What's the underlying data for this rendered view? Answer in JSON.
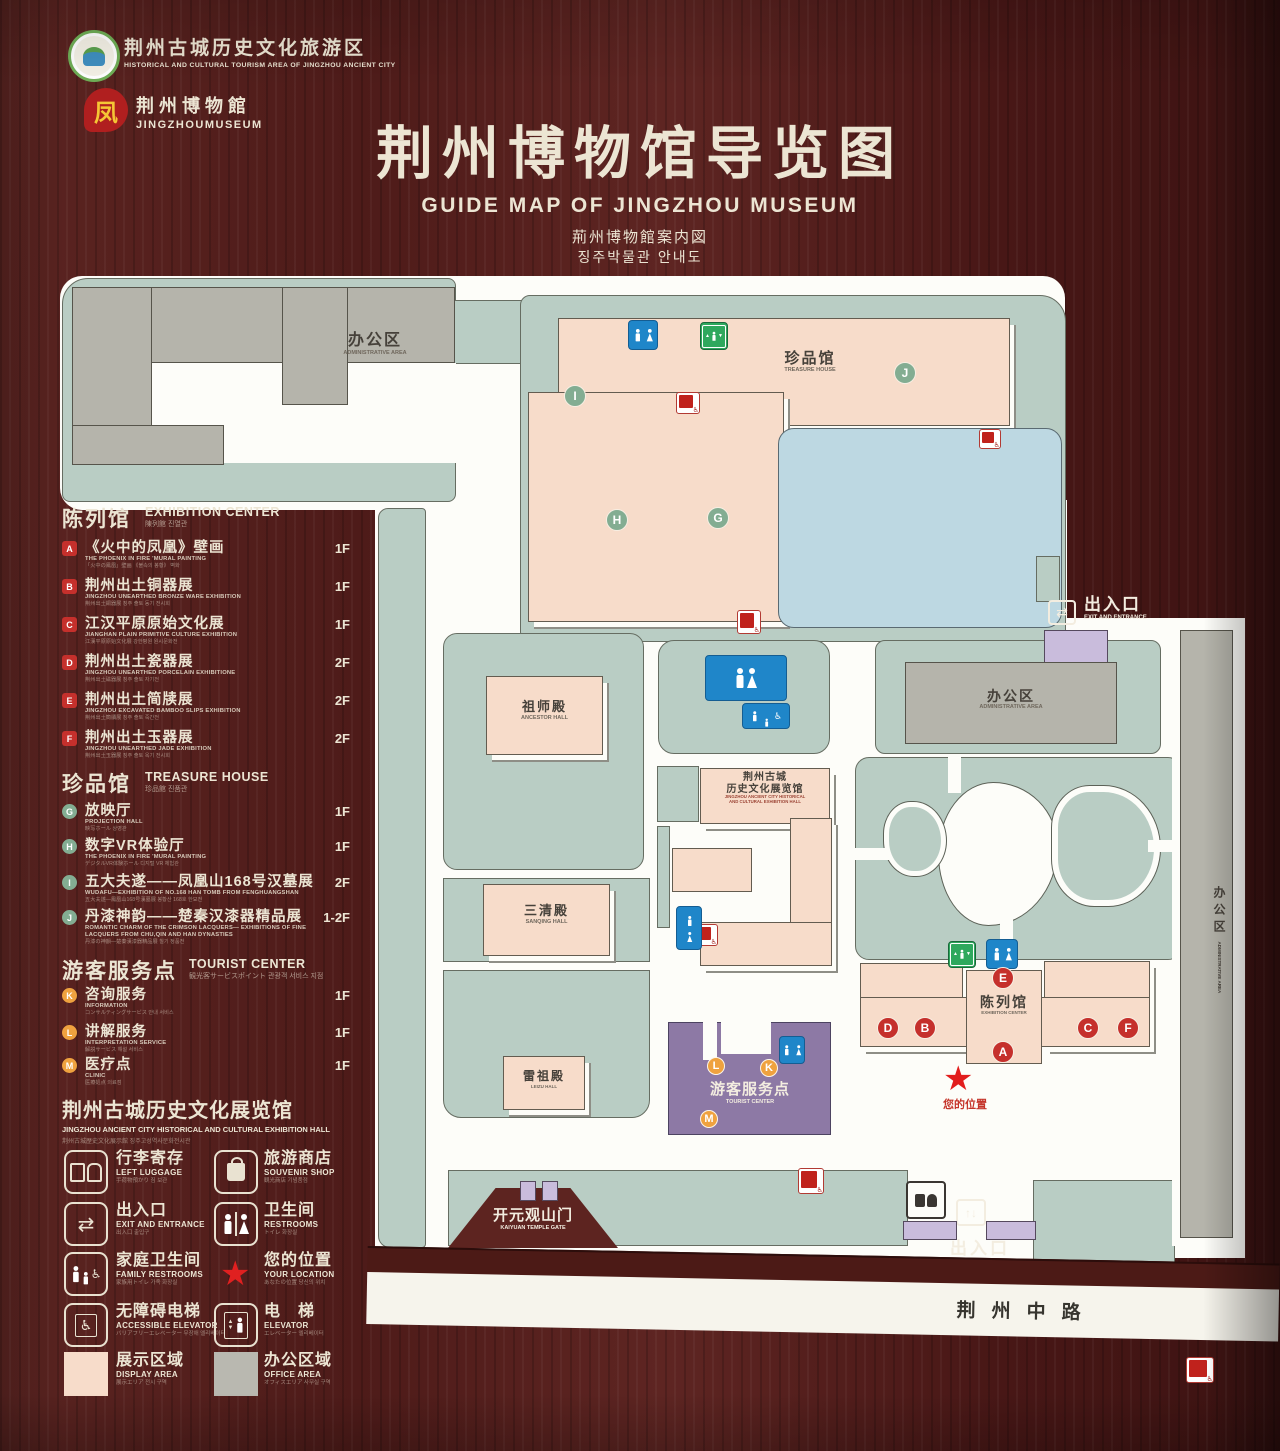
{
  "header": {
    "logo_tourism": {
      "cn": "荆州古城历史文化旅游区",
      "en": "HISTORICAL AND CULTURAL TOURISM AREA OF JINGZHOU ANCIENT CITY"
    },
    "logo_museum": {
      "cn": "荆州博物館",
      "en": "JINGZHOUMUSEUM"
    },
    "title_cn": "荆州博物馆导览图",
    "title_en": "GUIDE MAP OF JINGZHOU MUSEUM",
    "title_ja": "荊州博物館案内図",
    "title_ko": "징주박물관 안내도"
  },
  "legend": {
    "sections": [
      {
        "title_cn": "陈列馆",
        "title_en": "EXHIBITION CENTER",
        "title_sub": "陳列館 진열관",
        "items": [
          {
            "letter": "A",
            "cn": "《火中的凤凰》壁画",
            "en": "THE PHOENIX IN FIRE 'MURAL PAINTING",
            "sub": "「火中の鳳凰」壁画 《불속의 봉황》 벽화",
            "floor": "1F"
          },
          {
            "letter": "B",
            "cn": "荆州出土铜器展",
            "en": "JINGZHOU UNEARTHED BRONZE WARE EXHIBITION",
            "sub": "荆州出土銅器展 징주 출토 동기 전시회",
            "floor": "1F"
          },
          {
            "letter": "C",
            "cn": "江汉平原原始文化展",
            "en": "JIANGHAN PLAIN PRIMITIVE CULTURE EXHIBITION",
            "sub": "江漢平原原始文化展 강한평원 원시문화전",
            "floor": "1F"
          },
          {
            "letter": "D",
            "cn": "荆州出土瓷器展",
            "en": "JINGZHOU UNEARTHED PORCELAIN EXHIBITIONE",
            "sub": "荆州出土磁器展 징주 출토 자기전",
            "floor": "2F"
          },
          {
            "letter": "E",
            "cn": "荆州出土简牍展",
            "en": "JINGZHOU EXCAVATED BAMBOO SLIPS EXHIBITION",
            "sub": "荆州出土簡牘展 징주 출토 죽간전",
            "floor": "2F"
          },
          {
            "letter": "F",
            "cn": "荆州出土玉器展",
            "en": "JINGZHOU UNEARTHED JADE EXHIBITION",
            "sub": "荆州出土玉器展 징주 출토 옥기 전시회",
            "floor": "2F"
          }
        ]
      },
      {
        "title_cn": "珍品馆",
        "title_en": "TREASURE HOUSE",
        "title_sub": "珍品館 진품관",
        "items": [
          {
            "letter": "G",
            "cn": "放映厅",
            "en": "PROJECTION HALL",
            "sub": "映写ホール 상영관",
            "floor": "1F"
          },
          {
            "letter": "H",
            "cn": "数字VR体验厅",
            "en": "THE PHOENIX IN FIRE 'MURAL PAINTING",
            "sub": "デジタルVR体験ホール 디지털 VR 체험관",
            "floor": "1F"
          },
          {
            "letter": "I",
            "cn": "五大夫遂——凤凰山168号汉墓展",
            "en": "WUDAFU—EXHIBITION OF NO.168 HAN TOMB FROM FENGHUANGSHAN",
            "sub": "五大夫遂—鳳凰山168号漢墓展 봉황산 168호 한묘전",
            "floor": "2F"
          },
          {
            "letter": "J",
            "cn": "丹漆神韵——楚秦汉漆器精品展",
            "en": "ROMANTIC CHARM OF THE CRIMSON LACQUERS— EXHIBITIONS OF FINE LACQUERS FROM CHU,QIN AND HAN DYNASTIES",
            "sub": "丹漆の神韻—楚秦漢漆器精品展 칠기 정품전",
            "floor": "1-2F"
          }
        ]
      },
      {
        "title_cn": "游客服务点",
        "title_en": "TOURIST CENTER",
        "title_sub": "観光客サービスポイント 관광객 서비스 지점",
        "items": [
          {
            "letter": "K",
            "cn": "咨询服务",
            "en": "INFORMATION",
            "sub": "コンサルティングサービス 안내 서비스",
            "floor": "1F"
          },
          {
            "letter": "L",
            "cn": "讲解服务",
            "en": "INTERPRETATION SERVICE",
            "sub": "解説サービス 해설 서비스",
            "floor": "1F"
          },
          {
            "letter": "M",
            "cn": "医疗点",
            "en": "CLINIC",
            "sub": "医療処点 의료점",
            "floor": "1F"
          }
        ]
      }
    ],
    "hall_note": {
      "cn": "荆州古城历史文化展览馆",
      "en": "JINGZHOU ANCIENT CITY HISTORICAL AND CULTURAL EXHIBITION HALL",
      "sub": "荆州古城歴史文化展示館 징주고성역사문화전시관"
    },
    "icons": [
      {
        "cn": "行李寄存",
        "en": "LEFT LUGGAGE",
        "sub": "手荷物預かり 짐 보관"
      },
      {
        "cn": "旅游商店",
        "en": "SOUVENIR SHOP",
        "sub": "観光商店 기념품점"
      },
      {
        "cn": "出入口",
        "en": "EXIT AND ENTRANCE",
        "sub": "出入口 출입구"
      },
      {
        "cn": "卫生间",
        "en": "RESTROOMS",
        "sub": "トイレ 화장실"
      },
      {
        "cn": "家庭卫生间",
        "en": "FAMILY RESTROOMS",
        "sub": "家族用トイレ 가족 화장실"
      },
      {
        "cn": "您的位置",
        "en": "YOUR LOCATION",
        "sub": "あなたの位置 당신의 위치"
      },
      {
        "cn": "无障碍电梯",
        "en": "ACCESSIBLE ELEVATOR",
        "sub": "バリアフリーエレベーター 무장애 엘리베이터"
      },
      {
        "cn": "电　梯",
        "en": "ELEVATOR",
        "sub": "エレベーター 엘리베이터"
      },
      {
        "cn": "展示区域",
        "en": "DISPLAY AREA",
        "sub": "展示エリア 전시 구역"
      },
      {
        "cn": "办公区域",
        "en": "OFFICE AREA",
        "sub": "オフィスエリア 사무실 구역"
      }
    ]
  },
  "map": {
    "labels": {
      "admin_cn": "办公区",
      "admin_en": "ADMINISTRATIVE AREA",
      "treasure_cn": "珍品馆",
      "treasure_en": "TREASURE HOUSE",
      "ancestor_cn": "祖师殿",
      "ancestor_en": "ANCESTOR HALL",
      "sanqing_cn": "三清殿",
      "sanqing_en": "SANQING HALL",
      "leizu_cn": "雷祖殿",
      "leizu_en": "LEIZU HALL",
      "hall_cn1": "荆州古城",
      "hall_cn2": "历史文化展览馆",
      "hall_en1": "JINGZHOU ANCIENT CITY HISTORICAL",
      "hall_en2": "AND CULTURAL EXHIBITION HALL",
      "excenter_cn": "陈列馆",
      "excenter_en": "EXHIBITION CENTER",
      "tourist_cn": "游客服务点",
      "tourist_en": "TOURIST CENTER",
      "gate_cn": "开元观山门",
      "gate_en": "KAIYUAN TEMPLE GATE",
      "exit_cn": "出入口",
      "exit_en": "EXIT AND ENTRANCE",
      "road": "荆州中路",
      "location_cn": "您的位置"
    },
    "markers": {
      "A": "A",
      "B": "B",
      "C": "C",
      "D": "D",
      "E": "E",
      "F": "F",
      "G": "G",
      "H": "H",
      "I": "I",
      "J": "J",
      "K": "K",
      "L": "L",
      "M": "M"
    }
  },
  "colors": {
    "wood": "#54201d",
    "cream": "#ece5d3",
    "green_base": "#b9cdc4",
    "gray_building": "#b5b4ab",
    "pink_building": "#f7dcca",
    "pond_blue": "#bdd8e2",
    "purple_building": "#8d79a5",
    "wc_blue": "#1f86c9",
    "sign_green": "#2fa85d",
    "marker_red": "#c5302c",
    "marker_green": "#83ad92",
    "marker_orange": "#efa23f",
    "star_red": "#e21d1d"
  }
}
